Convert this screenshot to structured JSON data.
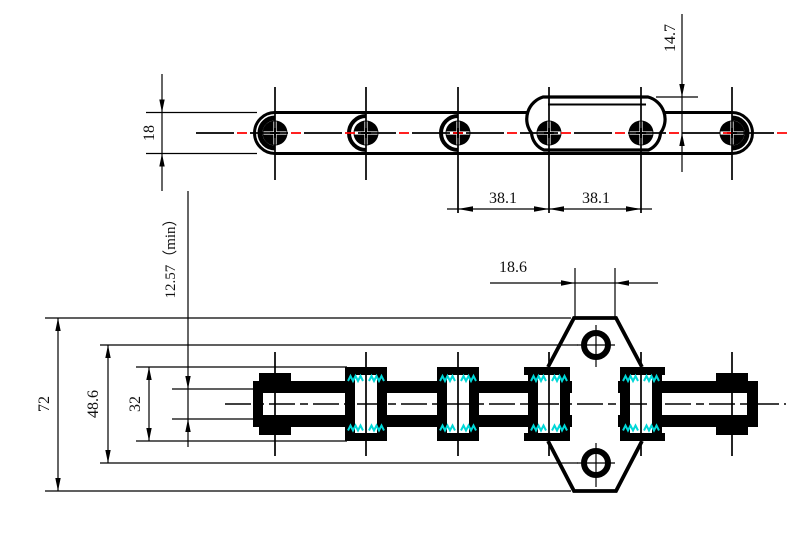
{
  "colors": {
    "line": "#000000",
    "centerline_red": "#ff0000",
    "hatch_cyan": "#00d8d8",
    "background": "#ffffff"
  },
  "top_view": {
    "dim_width": "18",
    "dim_attachment_height": "14.7",
    "dim_pitch_left": "38.1",
    "dim_pitch_right": "38.1"
  },
  "side_view": {
    "dim_overall_height": "72",
    "dim_hole_centers": "48.6",
    "dim_roller_diameter": "32",
    "dim_pin_diameter": "12.57（min）",
    "dim_attachment_top_width": "18.6"
  }
}
